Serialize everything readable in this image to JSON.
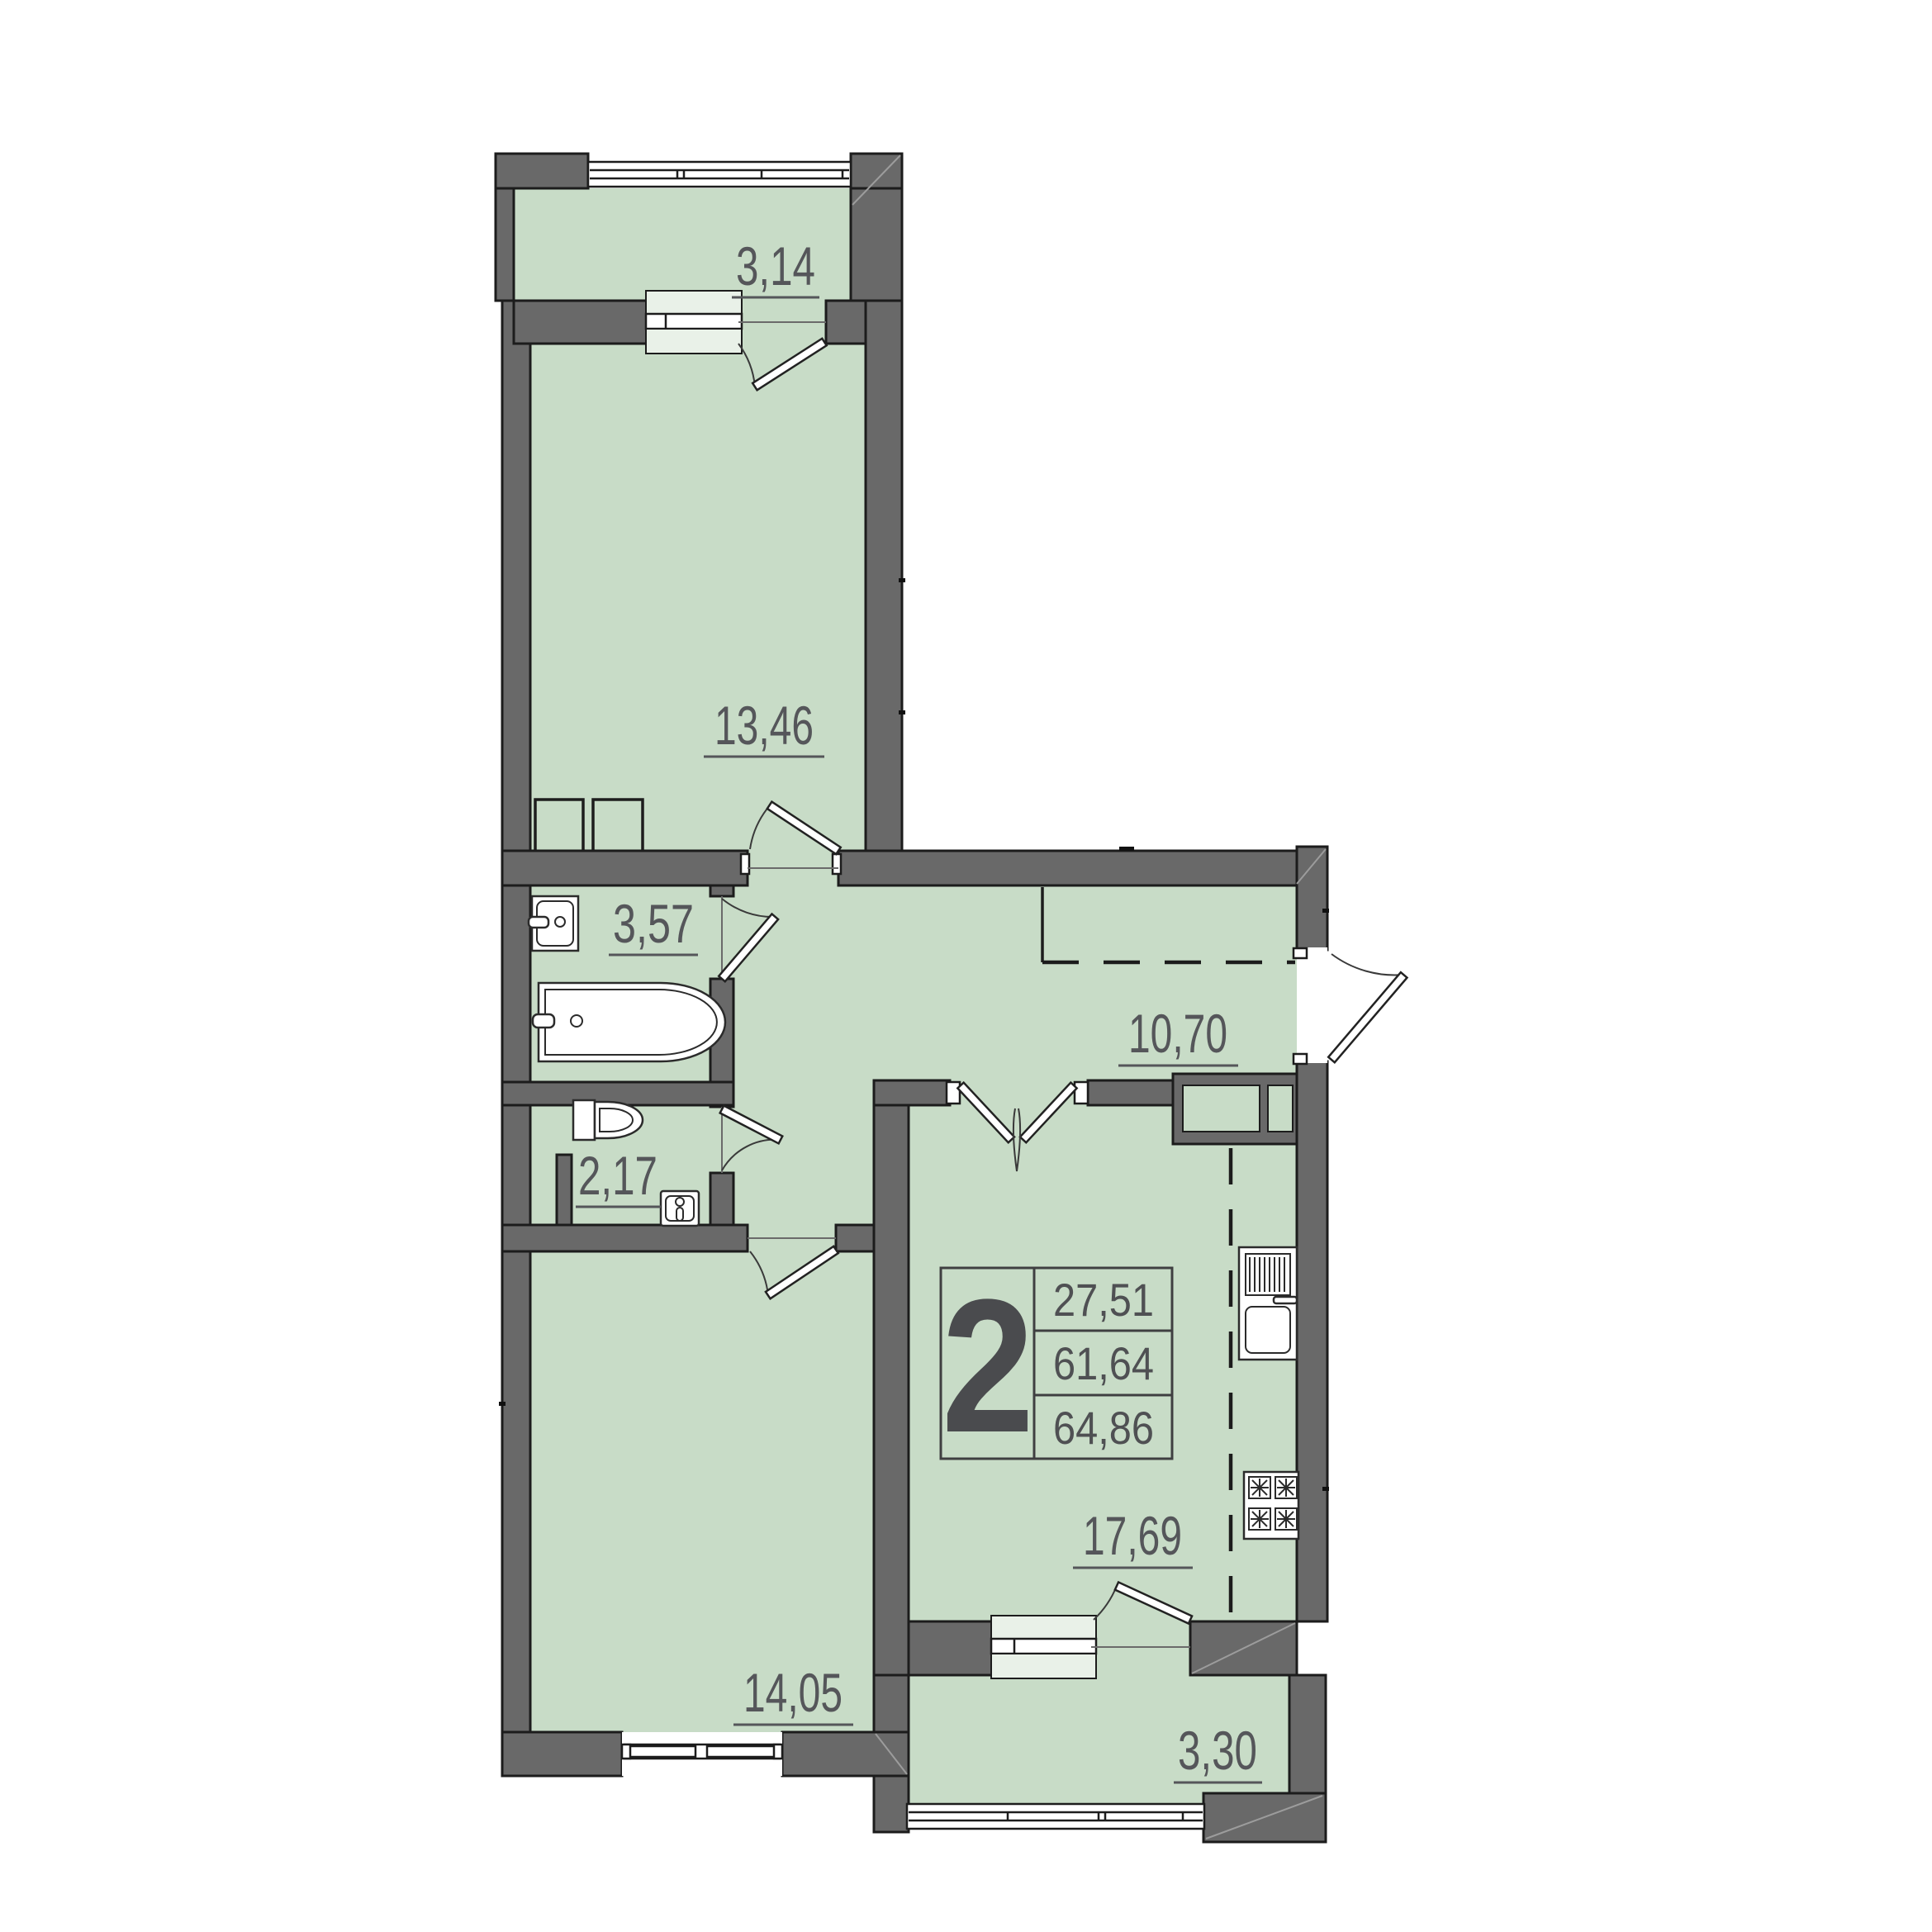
{
  "plan": {
    "title": "2-room apartment floor plan",
    "unit_badge": {
      "rooms": "2",
      "living_area": "27,51",
      "floor_area": "61,64",
      "total_area": "64,86"
    },
    "rooms": {
      "balcony_top": {
        "label": "3,14"
      },
      "bedroom": {
        "label": "13,46"
      },
      "bathroom": {
        "label": "3,57"
      },
      "wc": {
        "label": "2,17"
      },
      "hallway": {
        "label": "10,70"
      },
      "bedroom2": {
        "label": "14,05"
      },
      "kitchen_living": {
        "label": "17,69"
      },
      "balcony_bottom": {
        "label": "3,30"
      }
    },
    "fixtures": [
      "bathtub",
      "bathroom-sink",
      "toilet",
      "wc-sink",
      "kitchen-sink",
      "stove",
      "wardrobe"
    ],
    "colors": {
      "room_fill": "#c8dcc7",
      "wall_fill": "#696969",
      "wall_outline": "#1c1c1c",
      "sill_fill": "#e9f1e8",
      "label_color": "#55565a",
      "fixture_outline": "#2b2b2b"
    }
  }
}
